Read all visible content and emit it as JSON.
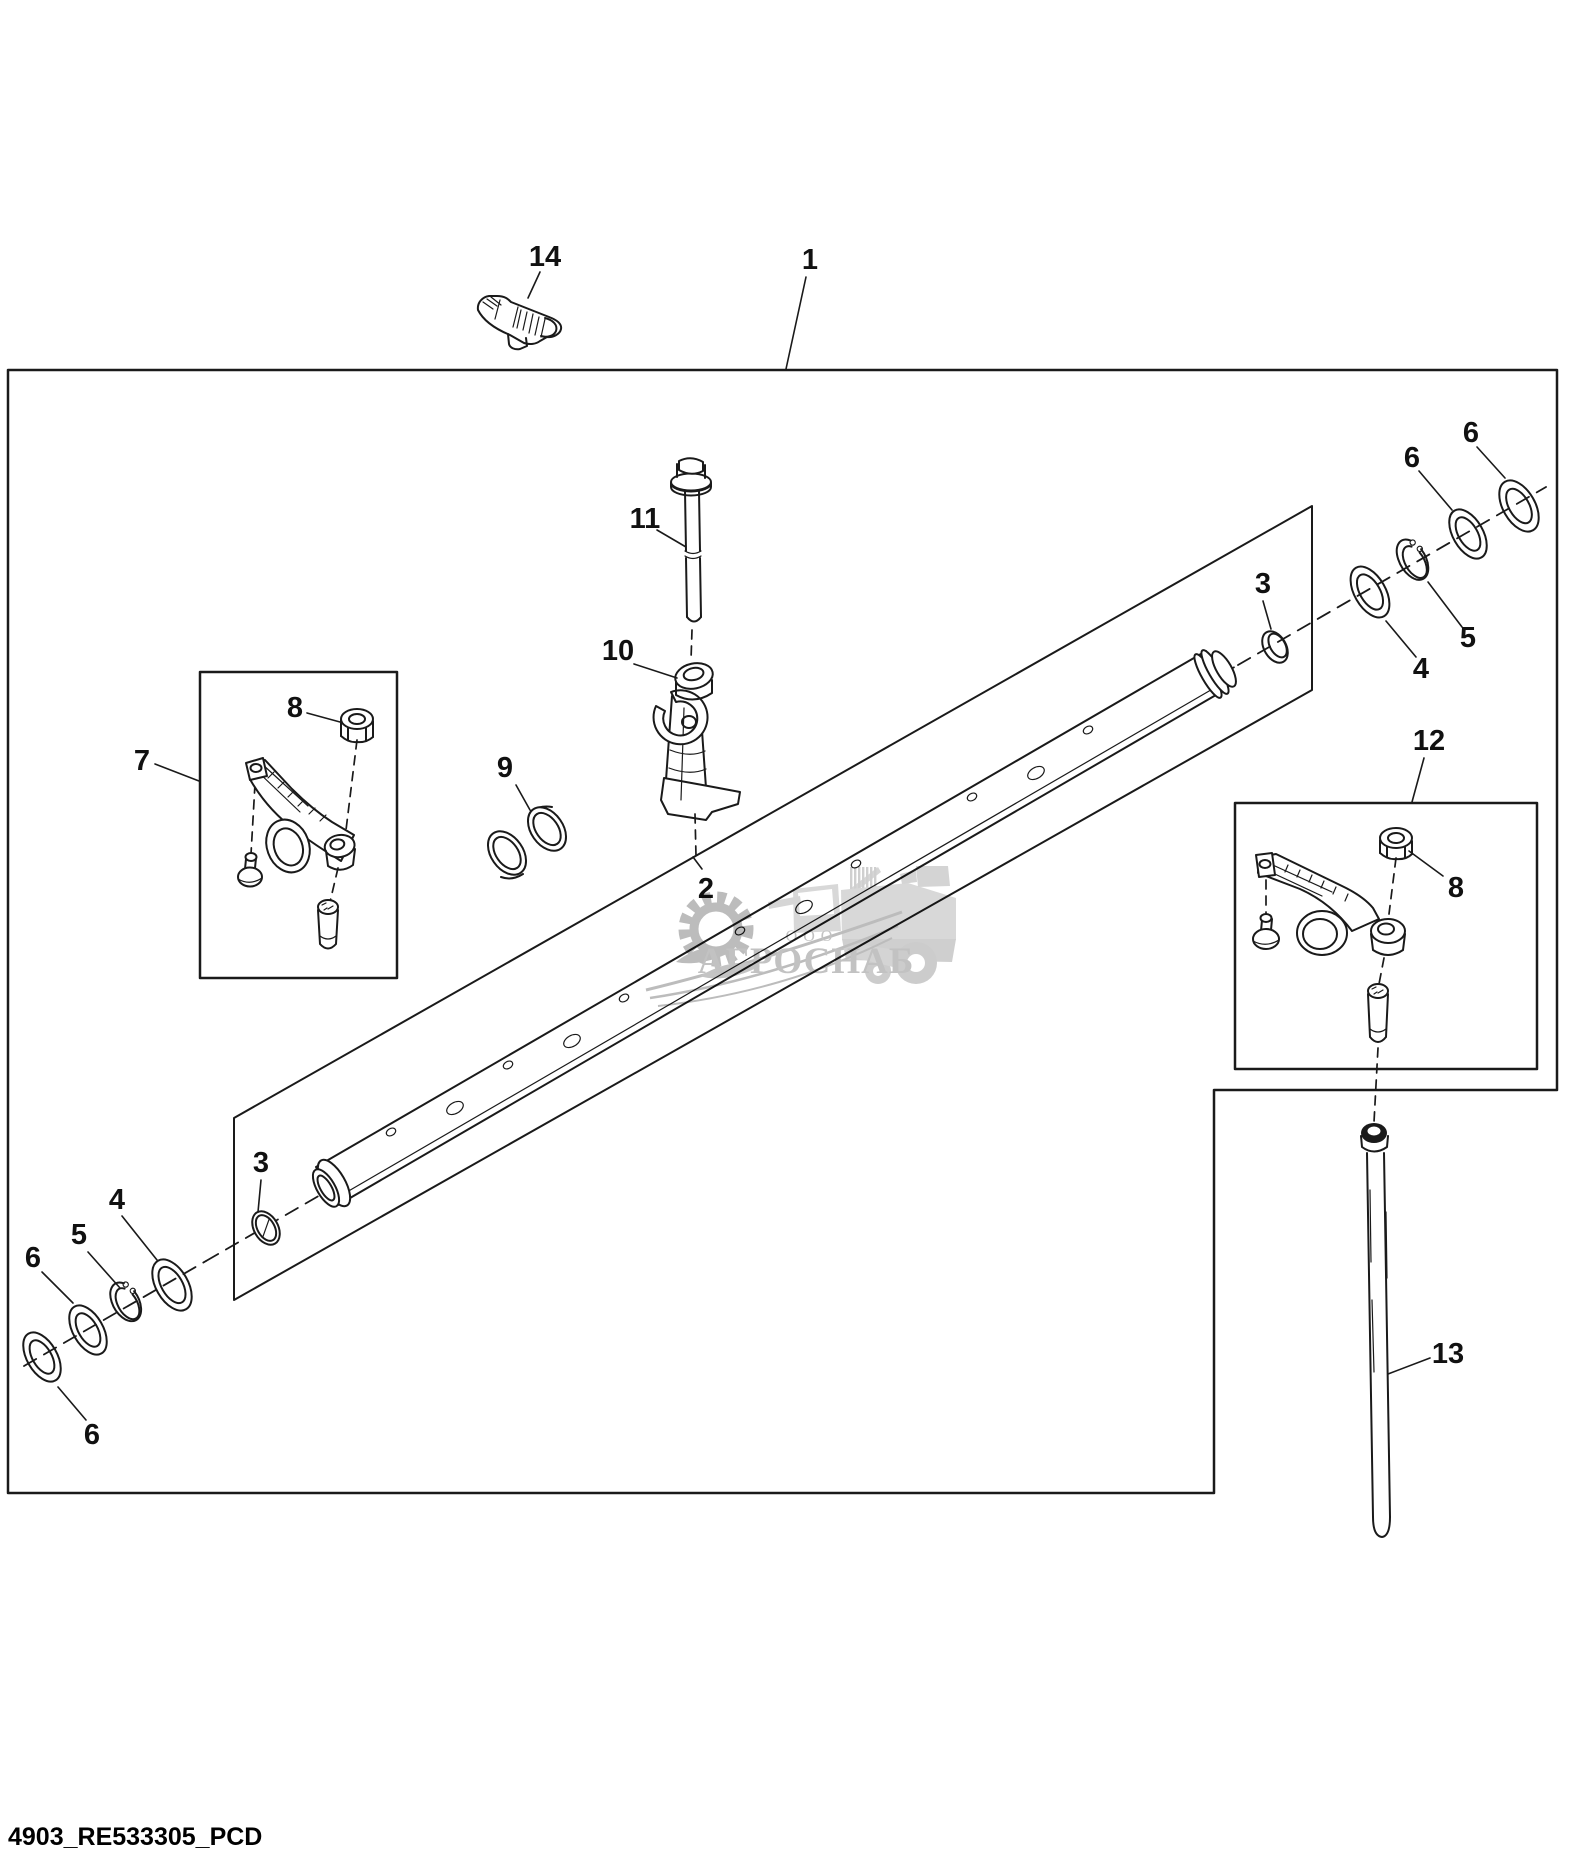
{
  "diagram": {
    "footer_code": "4903_RE533305_PCD",
    "watermark": {
      "org_type": "ООО",
      "name": "АГРОСНАБ"
    },
    "colors": {
      "line": "#1a1a1a",
      "background": "#ffffff",
      "watermark_gray": "#c2c2c2",
      "watermark_light": "#d8d8d8"
    },
    "callouts": [
      "14",
      "1",
      "11",
      "10",
      "7",
      "8",
      "9",
      "2",
      "3",
      "4",
      "5",
      "6",
      "6",
      "12",
      "8",
      "13",
      "3",
      "4",
      "5",
      "6",
      "6"
    ]
  }
}
